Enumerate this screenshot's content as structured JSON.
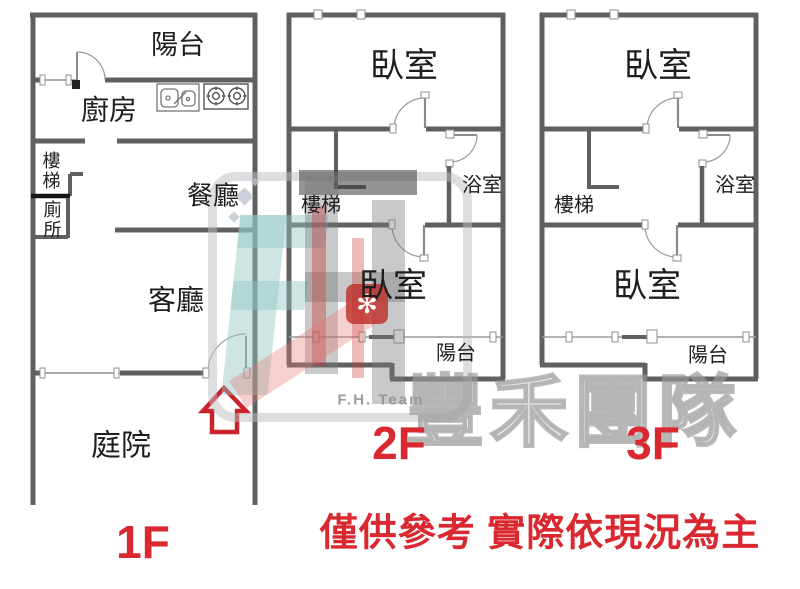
{
  "floors": [
    {
      "label": "1F",
      "rooms": {
        "balcony": "陽台",
        "kitchen": "廚房",
        "stairs": "樓梯",
        "toilet": "廁所",
        "dining": "餐廳",
        "living": "客廳",
        "courtyard": "庭院"
      }
    },
    {
      "label": "2F",
      "rooms": {
        "bedroom_top": "臥室",
        "stairs": "樓梯",
        "bathroom": "浴室",
        "bedroom_bottom": "臥室",
        "balcony": "陽台"
      }
    },
    {
      "label": "3F",
      "rooms": {
        "bedroom_top": "臥室",
        "stairs": "樓梯",
        "bathroom": "浴室",
        "bedroom_bottom": "臥室",
        "balcony": "陽台"
      }
    }
  ],
  "watermark": {
    "team_cn": "豐禾團隊",
    "team_en": "F.H. Team"
  },
  "disclaimer": "僅供參考 實際依現況為主",
  "colors": {
    "wall": "#606060",
    "accent_red": "#d9282f",
    "door_arc": "#9a9a9a",
    "watermark_teal": "#93c5c0",
    "watermark_gray": "#969696"
  }
}
